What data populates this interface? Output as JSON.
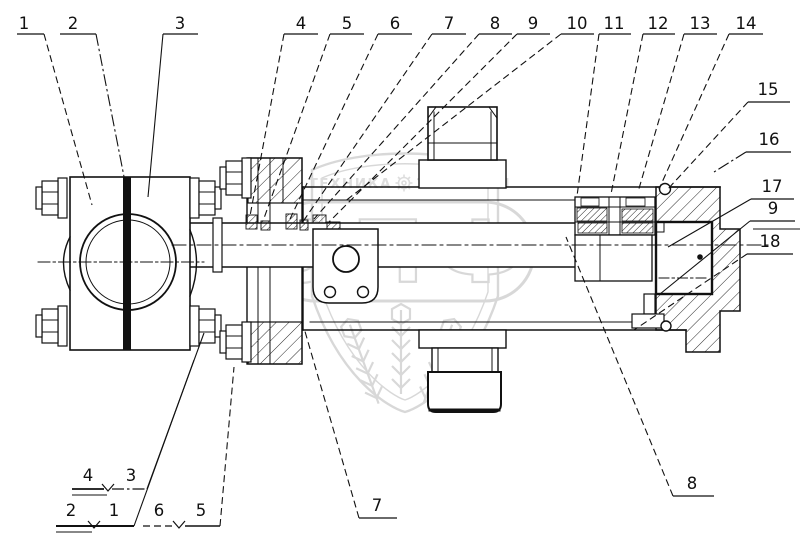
{
  "colors": {
    "line": "#111111",
    "watermark": "#b3b3b3",
    "background": "#ffffff"
  },
  "watermark": {
    "letters": "ЭПФ",
    "banner_left": "ТЕХНИКА",
    "banner_right": "ЗАПЧАСТИ"
  },
  "callouts": {
    "top": [
      {
        "label": "1",
        "tx": 24,
        "u": [
          17,
          44
        ],
        "leader": [
          44,
          34,
          92,
          205
        ],
        "style": "dash"
      },
      {
        "label": "2",
        "tx": 73,
        "u": [
          60,
          96
        ],
        "leader": [
          96,
          34,
          128,
          197
        ],
        "style": "dashdot"
      },
      {
        "label": "3",
        "tx": 180,
        "u": [
          163,
          198
        ],
        "leader": [
          163,
          34,
          148,
          197
        ],
        "style": "solid"
      },
      {
        "label": "4",
        "tx": 301,
        "u": [
          284,
          318
        ],
        "leader": [
          284,
          34,
          250,
          216
        ],
        "style": "dash"
      },
      {
        "label": "5",
        "tx": 347,
        "u": [
          330,
          364
        ],
        "leader": [
          330,
          34,
          263,
          221
        ],
        "style": "dash"
      },
      {
        "label": "6",
        "tx": 395,
        "u": [
          378,
          412
        ],
        "leader": [
          378,
          34,
          290,
          219
        ],
        "style": "dash"
      },
      {
        "label": "7",
        "tx": 449,
        "u": [
          432,
          466
        ],
        "leader": [
          432,
          34,
          302,
          223
        ],
        "style": "dash"
      },
      {
        "label": "8",
        "tx": 495,
        "u": [
          479,
          512
        ],
        "leader": [
          479,
          34,
          314,
          219
        ],
        "style": "dash"
      },
      {
        "label": "9",
        "tx": 533,
        "u": [
          517,
          550
        ],
        "leader": [
          517,
          34,
          328,
          223
        ],
        "style": "dash"
      },
      {
        "label": "10",
        "tx": 577,
        "u": [
          561,
          594
        ],
        "leader": [
          561,
          34,
          344,
          202
        ],
        "style": "dash"
      },
      {
        "label": "11",
        "tx": 614,
        "u": [
          599,
          631
        ],
        "leader": [
          599,
          34,
          577,
          196
        ],
        "style": "dash"
      },
      {
        "label": "12",
        "tx": 658,
        "u": [
          643,
          675
        ],
        "leader": [
          643,
          34,
          611,
          194
        ],
        "style": "dash"
      },
      {
        "label": "13",
        "tx": 700,
        "u": [
          684,
          717
        ],
        "leader": [
          684,
          34,
          638,
          192
        ],
        "style": "dash"
      },
      {
        "label": "14",
        "tx": 746,
        "u": [
          729,
          763
        ],
        "leader": [
          729,
          34,
          659,
          189
        ],
        "style": "dash"
      }
    ],
    "right": [
      {
        "label": "15",
        "tx": 768,
        "ty": 95,
        "u": [
          748,
          790,
          102
        ],
        "leader": [
          748,
          102,
          667,
          190
        ],
        "style": "dash"
      },
      {
        "label": "16",
        "tx": 769,
        "ty": 145,
        "u": [
          746,
          791,
          152
        ],
        "leader": [
          746,
          152,
          714,
          172
        ],
        "style": "dashdot"
      },
      {
        "label": "17",
        "tx": 772,
        "ty": 192,
        "u": [
          751,
          794,
          199
        ],
        "leader": [
          751,
          199,
          668,
          247
        ],
        "style": "solid"
      },
      {
        "label": "9",
        "tx": 773,
        "ty": 214,
        "u": [
          750,
          795,
          221
        ],
        "extra": [
          753,
          800,
          229
        ],
        "leader": [
          750,
          221,
          660,
          294
        ],
        "style": "solid"
      },
      {
        "label": "18",
        "tx": 770,
        "ty": 247,
        "u": [
          747,
          793,
          254
        ],
        "leader": [
          747,
          254,
          634,
          330
        ],
        "style": "dash"
      }
    ],
    "bottom": [
      {
        "label": "8",
        "tx": 692,
        "ty": 489,
        "u": [
          673,
          714,
          496
        ],
        "leader": [
          673,
          496,
          566,
          237
        ],
        "style": "dash"
      },
      {
        "label": "7",
        "tx": 377,
        "ty": 511,
        "u": [
          359,
          397,
          518
        ],
        "leader": [
          359,
          518,
          304,
          328
        ],
        "style": "dash"
      }
    ],
    "groups": [
      {
        "digits": [
          {
            "label": "4",
            "x": 88,
            "y": 481
          },
          {
            "label": "3",
            "x": 131,
            "y": 481
          }
        ],
        "lines": [
          {
            "x1": 72,
            "y1": 489,
            "x2": 104,
            "y2": 489,
            "style": "solid",
            "w": 1.8
          },
          {
            "x1": 72,
            "y1": 495,
            "x2": 107,
            "y2": 495,
            "style": "solid",
            "w": 1
          },
          {
            "x1": 112,
            "y1": 489,
            "x2": 147,
            "y2": 489,
            "style": "dashdot",
            "w": 1.2
          }
        ],
        "vee": {
          "x": 108,
          "y": 489
        },
        "leader": {
          "x1": 147,
          "y1": 489,
          "x2": 204,
          "y2": 333,
          "style": "solid"
        }
      },
      {
        "digits": [
          {
            "label": "2",
            "x": 71,
            "y": 516
          },
          {
            "label": "1",
            "x": 114,
            "y": 516
          }
        ],
        "lines": [
          {
            "x1": 56,
            "y1": 526,
            "x2": 134,
            "y2": 526,
            "style": "solid",
            "w": 2
          },
          {
            "x1": 56,
            "y1": 532,
            "x2": 92,
            "y2": 532,
            "style": "solid",
            "w": 1
          }
        ],
        "vee": {
          "x": 94,
          "y": 526
        },
        "leader": {
          "x1": 134,
          "y1": 526,
          "x2": 194,
          "y2": 360,
          "style": "solid"
        }
      },
      {
        "digits": [
          {
            "label": "6",
            "x": 159,
            "y": 516
          },
          {
            "label": "5",
            "x": 201,
            "y": 516
          }
        ],
        "lines": [
          {
            "x1": 143,
            "y1": 526,
            "x2": 173,
            "y2": 526,
            "style": "dash",
            "w": 1.2
          },
          {
            "x1": 185,
            "y1": 526,
            "x2": 220,
            "y2": 526,
            "style": "solid",
            "w": 1.6
          }
        ],
        "vee": {
          "x": 179,
          "y": 526
        },
        "leader": {
          "x1": 220,
          "y1": 526,
          "x2": 234,
          "y2": 367,
          "style": "dash"
        }
      }
    ]
  }
}
